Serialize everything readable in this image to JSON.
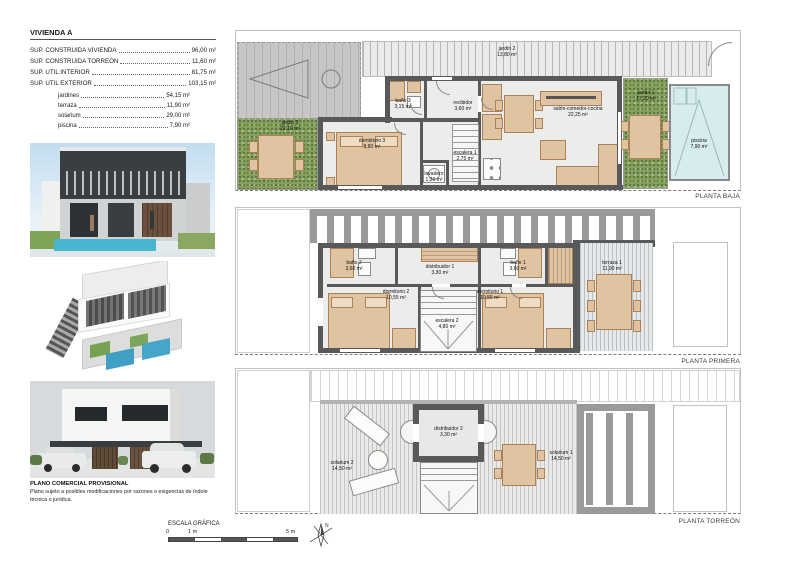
{
  "title_block": {
    "title": "VIVIENDA A",
    "rows": [
      {
        "label": "SUP. CONSTRUIDA VIVIENDA",
        "value": "96,00 m²"
      },
      {
        "label": "SUP. CONSTRUIDA TORREÓN",
        "value": "11,60 m²"
      },
      {
        "label": "SUP. UTIL INTERIOR",
        "value": "81,75 m²"
      },
      {
        "label": "SUP. UTIL EXTERIOR",
        "value": "103,15 m²"
      }
    ],
    "subrows": [
      {
        "label": "jardines",
        "value": "54,15 m²"
      },
      {
        "label": "terraza",
        "value": "11,90 m²"
      },
      {
        "label": "solarium",
        "value": "29,00 m²"
      },
      {
        "label": "piscina",
        "value": "7,90 m²"
      }
    ]
  },
  "disclaimer": {
    "heading": "PLANO COMERCIAL PROVISIONAL",
    "body": "Plano sujeto a posibles modificaciones por razones o exigencias de índole técnica o jurídica."
  },
  "scale_bar": {
    "label": "ESCALA GRÁFICA",
    "tick0": "0",
    "tick1": "1 m",
    "tick5": "5 m"
  },
  "compass": {
    "label": "N"
  },
  "plans": {
    "baja": {
      "name": "PLANTA BAJA",
      "rooms": {
        "jardin2": {
          "name": "jardín 2",
          "area": "13,80 m²"
        },
        "jardin3": {
          "name": "jardín 3",
          "area": "22,10 m²"
        },
        "dormitorio3": {
          "name": "dormitorio 3",
          "area": "8,80 m²"
        },
        "bano3": {
          "name": "baño 3",
          "area": "3,15 m²"
        },
        "recibidor": {
          "name": "recibidor",
          "area": "3,60 m²"
        },
        "lavadero": {
          "name": "lavadero",
          "area": "1,20 m²"
        },
        "escalera1": {
          "name": "escalera 1",
          "area": "2,75 m²"
        },
        "salon": {
          "name": "salón-comedor-cocina",
          "area": "22,25 m²"
        },
        "jardin1": {
          "name": "jardín 1",
          "area": "17,20 m²"
        },
        "piscina": {
          "name": "piscina",
          "area": "7,90 m²"
        }
      }
    },
    "primera": {
      "name": "PLANTA PRIMERA",
      "rooms": {
        "bano2": {
          "name": "baño 2",
          "area": "3,60 m²"
        },
        "distribuidor1": {
          "name": "distribuidor 1",
          "area": "3,30 m²"
        },
        "bano1": {
          "name": "baño 1",
          "area": "3,60 m²"
        },
        "dormitorio2": {
          "name": "dormitorio 2",
          "area": "10,55 m²"
        },
        "dormitorio1": {
          "name": "dormitorio 1",
          "area": "10,55 m²"
        },
        "escalera2": {
          "name": "escalera 2",
          "area": "4,80 m²"
        },
        "terraza1": {
          "name": "terraza 1",
          "area": "11,90 m²"
        }
      }
    },
    "torreon": {
      "name": "PLANTA TORREÓN",
      "rooms": {
        "solarium2": {
          "name": "solarium 2",
          "area": "14,50 m²"
        },
        "distribuidor2": {
          "name": "distribuidor 2",
          "area": "3,30 m²"
        },
        "solarium1": {
          "name": "solarium 1",
          "area": "14,50 m²"
        }
      }
    }
  },
  "colors": {
    "wall": "#58595b",
    "pergola": "#9a9a9a",
    "grass": "#86a15f",
    "pool_water": "#d7ecee",
    "render_pool": "#45aecb",
    "wood_furniture": "#e0c3a0"
  }
}
